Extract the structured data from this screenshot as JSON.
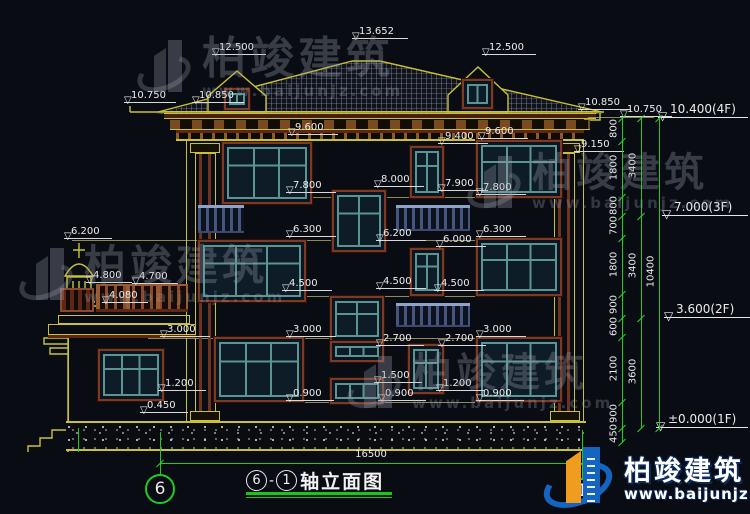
{
  "meta": {
    "drawing_title": "轴立面图",
    "axis_start": "6",
    "axis_end": "1",
    "title_dash": "-"
  },
  "watermark": {
    "name": "柏竣建筑",
    "url": "www.baijunjz.com",
    "instances": [
      {
        "x": 138,
        "y": 36,
        "name_size": 44
      },
      {
        "x": 20,
        "y": 244,
        "name_size": 42
      },
      {
        "x": 468,
        "y": 152,
        "name_size": 40
      },
      {
        "x": 348,
        "y": 352,
        "name_size": 40
      }
    ]
  },
  "brand_logo": {
    "name": "柏竣建筑",
    "url": "www.baijunjz.com"
  },
  "annotations": {
    "elevation_markers": [
      {
        "t": "13.652",
        "x": 352,
        "y": 26,
        "w": 56
      },
      {
        "t": "12.500",
        "x": 212,
        "y": 42,
        "w": 54
      },
      {
        "t": "12.500",
        "x": 482,
        "y": 42,
        "w": 54
      },
      {
        "t": "10.750",
        "x": 124,
        "y": 90,
        "w": 52
      },
      {
        "t": "10.850",
        "x": 192,
        "y": 90,
        "w": 52
      },
      {
        "t": "10.850",
        "x": 578,
        "y": 97,
        "w": 52
      },
      {
        "t": "10.750",
        "x": 620,
        "y": 104,
        "w": 52
      },
      {
        "t": "9.600",
        "x": 288,
        "y": 122,
        "w": 50
      },
      {
        "t": "9.600",
        "x": 478,
        "y": 126,
        "w": 50
      },
      {
        "t": "9.400",
        "x": 438,
        "y": 131,
        "w": 50
      },
      {
        "t": "9.150",
        "x": 574,
        "y": 139,
        "w": 50
      },
      {
        "t": "8.000",
        "x": 374,
        "y": 174,
        "w": 50
      },
      {
        "t": "7.900",
        "x": 438,
        "y": 178,
        "w": 50
      },
      {
        "t": "7.800",
        "x": 286,
        "y": 180,
        "w": 50
      },
      {
        "t": "7.800",
        "x": 476,
        "y": 182,
        "w": 50
      },
      {
        "t": "6.200",
        "x": 64,
        "y": 226,
        "w": 48
      },
      {
        "t": "6.300",
        "x": 286,
        "y": 224,
        "w": 50
      },
      {
        "t": "6.200",
        "x": 376,
        "y": 228,
        "w": 50
      },
      {
        "t": "6.300",
        "x": 476,
        "y": 224,
        "w": 50
      },
      {
        "t": "6.000",
        "x": 436,
        "y": 234,
        "w": 50
      },
      {
        "t": "4.800",
        "x": 86,
        "y": 270,
        "w": 46
      },
      {
        "t": "4.700",
        "x": 132,
        "y": 271,
        "w": 46
      },
      {
        "t": "4.080",
        "x": 102,
        "y": 290,
        "w": 46
      },
      {
        "t": "4.500",
        "x": 282,
        "y": 278,
        "w": 50
      },
      {
        "t": "4.500",
        "x": 376,
        "y": 276,
        "w": 50
      },
      {
        "t": "4.500",
        "x": 434,
        "y": 278,
        "w": 50
      },
      {
        "t": "3.000",
        "x": 160,
        "y": 324,
        "w": 50
      },
      {
        "t": "3.000",
        "x": 286,
        "y": 324,
        "w": 50
      },
      {
        "t": "3.000",
        "x": 476,
        "y": 324,
        "w": 50
      },
      {
        "t": "2.700",
        "x": 376,
        "y": 333,
        "w": 48
      },
      {
        "t": "2.700",
        "x": 438,
        "y": 333,
        "w": 48
      },
      {
        "t": "1.500",
        "x": 374,
        "y": 370,
        "w": 48
      },
      {
        "t": "1.200",
        "x": 158,
        "y": 378,
        "w": 48
      },
      {
        "t": "1.200",
        "x": 436,
        "y": 378,
        "w": 48
      },
      {
        "t": "0.900",
        "x": 286,
        "y": 388,
        "w": 48
      },
      {
        "t": "0.900",
        "x": 378,
        "y": 388,
        "w": 48
      },
      {
        "t": "0.900",
        "x": 476,
        "y": 388,
        "w": 48
      },
      {
        "t": "0.450",
        "x": 140,
        "y": 400,
        "w": 48
      }
    ],
    "floor_markers": [
      {
        "t": "10.400(4F)",
        "x": 658,
        "y": 103,
        "w": 90
      },
      {
        "t": "7.000(3F)",
        "x": 662,
        "y": 201,
        "w": 86
      },
      {
        "t": "3.600(2F)",
        "x": 664,
        "y": 303,
        "w": 86
      },
      {
        "t": "±0.000(1F)",
        "x": 656,
        "y": 413,
        "w": 92
      }
    ]
  },
  "dimensions": {
    "right_chains": [
      {
        "x": 622,
        "segments": [
          {
            "label": "800",
            "y0": 118,
            "y1": 141
          },
          {
            "label": "1800",
            "y0": 141,
            "y1": 197
          },
          {
            "label": "800",
            "y0": 197,
            "y1": 216
          },
          {
            "label": "700",
            "y0": 216,
            "y1": 238
          },
          {
            "label": "1800",
            "y0": 238,
            "y1": 294
          },
          {
            "label": "900",
            "y0": 294,
            "y1": 318
          },
          {
            "label": "600",
            "y0": 318,
            "y1": 337
          },
          {
            "label": "2100",
            "y0": 337,
            "y1": 402
          },
          {
            "label": "900",
            "y0": 402,
            "y1": 428
          },
          {
            "label": "450",
            "y0": 428,
            "y1": 442
          }
        ]
      },
      {
        "x": 641,
        "segments": [
          {
            "label": "3400",
            "y0": 118,
            "y1": 216
          },
          {
            "label": "3400",
            "y0": 216,
            "y1": 318
          },
          {
            "label": "3600",
            "y0": 318,
            "y1": 428
          }
        ]
      },
      {
        "x": 659,
        "segments": [
          {
            "label": "10400",
            "y0": 118,
            "y1": 428
          }
        ]
      }
    ],
    "bottom": {
      "label": "16500",
      "x1": 160,
      "x2": 582,
      "y": 463
    }
  },
  "axis_bubbles": [
    {
      "n": "6",
      "x": 160,
      "y": 489,
      "r": 15
    },
    {
      "n": "1",
      "x": 582,
      "y": 491,
      "r": 13
    }
  ],
  "colors": {
    "background": "#0a0c14",
    "line_yellow": "#c8c236",
    "dim_white": "#ececec",
    "axis_green": "#1fcb22",
    "window_teal": "#5b9494",
    "frame_brown": "#7c3a26",
    "logo_blue": "#1565c0",
    "logo_orange": "#f09c1e"
  }
}
